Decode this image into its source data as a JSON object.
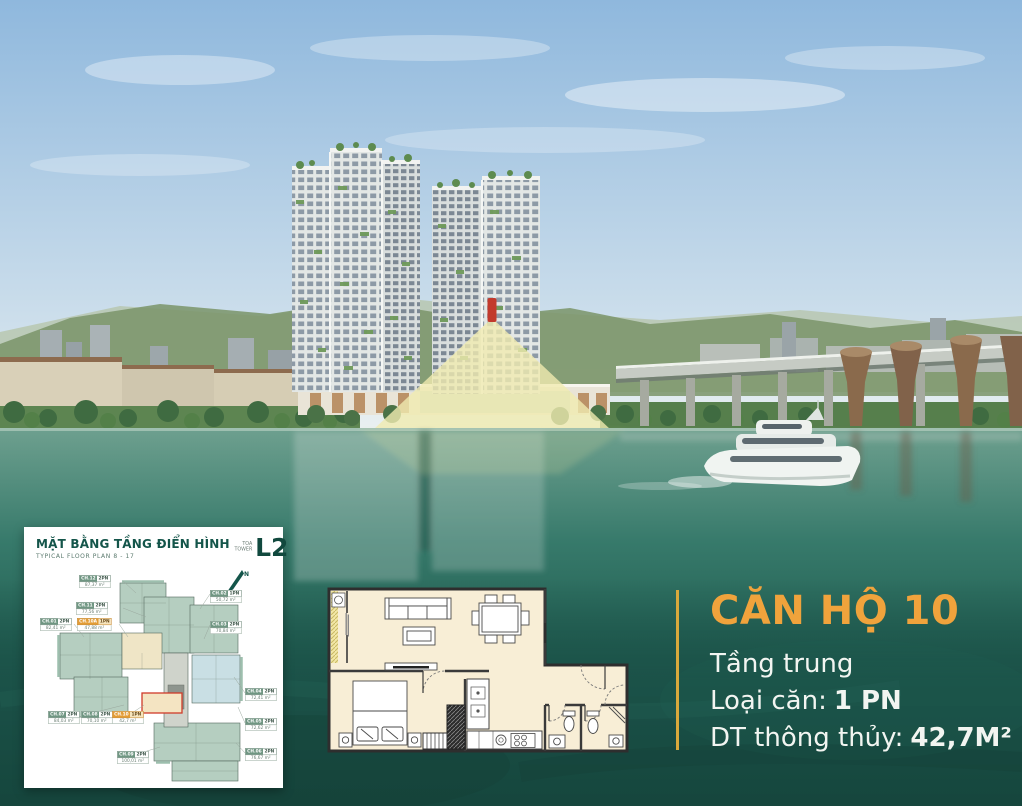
{
  "panel": {
    "title": "MẶT BẰNG TẦNG ĐIỂN HÌNH",
    "subtitle": "TYPICAL FLOOR PLAN 8 - 17",
    "tower_label_vn": "TÒA",
    "tower_label_en": "TOWER",
    "tower_code": "L2",
    "north_label": "N",
    "units": [
      {
        "id": "CH.12",
        "type": "2PN",
        "area": "87,37 m²",
        "highlight": false
      },
      {
        "id": "CH.11",
        "type": "2PN",
        "area": "77,56 m²",
        "highlight": false
      },
      {
        "id": "CH.01",
        "type": "2PN",
        "area": "82,41 m²",
        "highlight": false
      },
      {
        "id": "CH.10A",
        "type": "1PN",
        "area": "47,88 m²",
        "highlight": true
      },
      {
        "id": "CH.02",
        "type": "1PN",
        "area": "50,72 m²",
        "highlight": false
      },
      {
        "id": "CH.03",
        "type": "2PN",
        "area": "70,84 m²",
        "highlight": false
      },
      {
        "id": "CH.04",
        "type": "2PN",
        "area": "72,41 m²",
        "highlight": false
      },
      {
        "id": "CH.05",
        "type": "2PN",
        "area": "72,62 m²",
        "highlight": false
      },
      {
        "id": "CH.06",
        "type": "2PN",
        "area": "76,67 m²",
        "highlight": false
      },
      {
        "id": "CH.07",
        "type": "2PN",
        "area": "84,03 m²",
        "highlight": false
      },
      {
        "id": "CH.08",
        "type": "2PN",
        "area": "70,10 m²",
        "highlight": false
      },
      {
        "id": "CH.10",
        "type": "1PN",
        "area": "42,7 m²",
        "highlight": true
      },
      {
        "id": "CH.09",
        "type": "2PN",
        "area": "100,01 m²",
        "highlight": false
      }
    ]
  },
  "apartment": {
    "name": "CĂN HỘ 10",
    "floor_label": "Tầng trung",
    "type_label": "Loại căn:",
    "type_value": "1 PN",
    "area_label": "DT thông thủy:",
    "area_value": "42,7M²"
  },
  "colors": {
    "accent_gold": "#F0A33C",
    "divider_gold": "#D9A93C",
    "panel_green": "#14554A",
    "background_green": "#1B5148",
    "highlight_red": "#CF3A2A"
  }
}
